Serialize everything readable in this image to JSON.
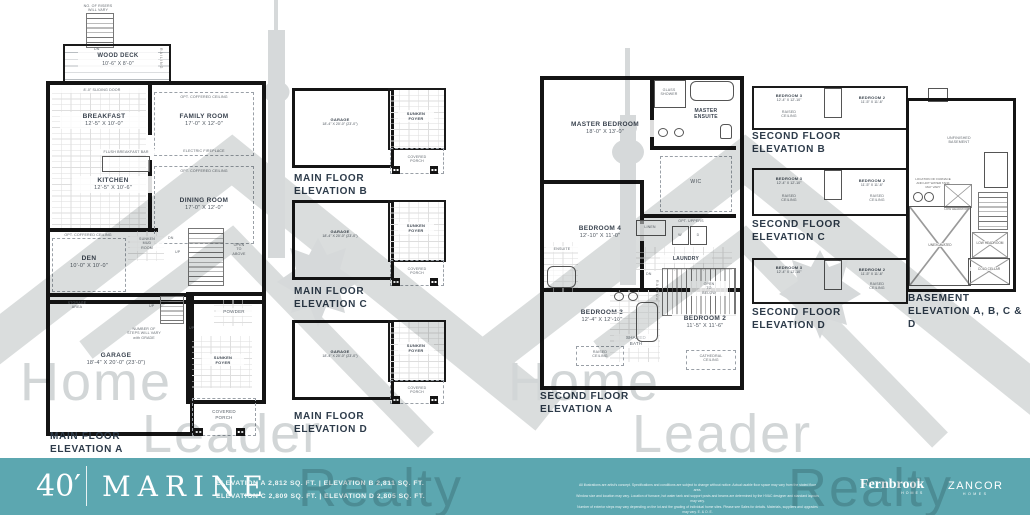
{
  "wm": {
    "w1": "Home",
    "w2": "Leader",
    "w3": "Realty"
  },
  "mfa": {
    "t1": "MAIN FLOOR",
    "t2": "ELEVATION A",
    "risers1": "NO. OF RISERS",
    "risers2": "WILL VARY",
    "dn": "DN",
    "up": "UP",
    "deck1": "WOOD DECK",
    "deck2": "10'-6\" X 8'-0\"",
    "railing": "RAILING",
    "sliding": "8'-0\" SLIDING DOOR",
    "coff": "OPT. COFFERED CEILING",
    "brk1": "BREAKFAST",
    "brk2": "12'-5\" X 10'-0\"",
    "fam1": "FAMILY ROOM",
    "fam2": "17'-0\" X 12'-0\"",
    "fire": "ELECTRIC FIREPLACE",
    "bar": "FLUSH BREAKFAST BAR",
    "kit1": "KITCHEN",
    "kit2": "12'-5\" X 10'-6\"",
    "din1": "DINING ROOM",
    "din2": "17'-0\" X 12'-0\"",
    "den1": "DEN",
    "den2": "10'-0\" X 10'-0\"",
    "mud1": "SUNKEN",
    "mud2": "MUD",
    "mud3": "ROOM",
    "open1": "OPEN",
    "open2": "TO",
    "open3": "ABOVE",
    "sto1": "STORAGE",
    "sto2": "AREA",
    "gar1": "GARAGE",
    "gar2": "18'-4\" X 20'-0\" (23'-0\")",
    "steps1": "NUMBER OF",
    "steps2": "STEPS WILL VARY",
    "steps3": "with GRADE",
    "pow": "POWDER",
    "foy1": "SUNKEN",
    "foy2": "FOYER",
    "por1": "COVERED",
    "por2": "PORCH"
  },
  "mfb": {
    "t1": "MAIN FLOOR",
    "t2": "ELEVATION B",
    "gar1": "GARAGE",
    "gar2": "18'-4\" X 20'-0\" (23'-0\")",
    "foy1": "SUNKEN",
    "foy2": "FOYER",
    "por1": "COVERED",
    "por2": "PORCH"
  },
  "mfc": {
    "t1": "MAIN FLOOR",
    "t2": "ELEVATION C",
    "gar1": "GARAGE",
    "gar2": "18'-4\" X 20'-0\" (23'-0\")",
    "foy1": "SUNKEN",
    "foy2": "FOYER",
    "por1": "COVERED",
    "por2": "PORCH"
  },
  "mfd": {
    "t1": "MAIN FLOOR",
    "t2": "ELEVATION D",
    "gar1": "GARAGE",
    "gar2": "18'-4\" X 20'-0\" (23'-0\")",
    "foy1": "SUNKEN",
    "foy2": "FOYER",
    "por1": "COVERED",
    "por2": "PORCH"
  },
  "sfa": {
    "t1": "SECOND FLOOR",
    "t2": "ELEVATION A",
    "mas1": "MASTER BEDROOM",
    "mas2": "18'-0\" X 13'-0\"",
    "gs1": "GLASS",
    "gs2": "SHOWER",
    "me1": "MASTER",
    "me2": "ENSUITE",
    "wic": "WIC",
    "b4": "BEDROOM 4",
    "b4d": "12'-10\" X 11'-0\"",
    "lin": "LINEN",
    "optup": "OPT. UPPERS",
    "w": "W",
    "d": "D",
    "lau": "LAUNDRY",
    "dn": "DN",
    "rail": "RAILING",
    "ob1": "OPEN",
    "ob2": "TO",
    "ob3": "BELOW",
    "ens": "ENSUITE",
    "b3": "BEDROOM 3",
    "b3d": "12'-4\" X 12'-10\"",
    "sh1": "SHARED",
    "sh2": "BATH",
    "rc1": "RAISED",
    "rc2": "CEILING",
    "b2": "BEDROOM 2",
    "b2d": "11'-5\" X 11'-6\"",
    "cat1": "CATHEDRAL",
    "cat2": "CEILING"
  },
  "sfb": {
    "t1": "SECOND FLOOR",
    "t2": "ELEVATION B",
    "b3": "BEDROOM 3",
    "b3d": "12'-4\" X 12'-10\"",
    "b2": "BEDROOM 2",
    "b2d": "11'-5\" X 11'-6\"",
    "rc1": "RAISED",
    "rc2": "CEILING"
  },
  "sfc": {
    "t1": "SECOND FLOOR",
    "t2": "ELEVATION C",
    "b3": "BEDROOM 3",
    "b3d": "12'-4\" X 12'-10\"",
    "b2": "BEDROOM 2",
    "b2d": "11'-5\" X 11'-6\"",
    "rc1": "RAISED",
    "rc2": "CEILING"
  },
  "sfd": {
    "t1": "SECOND FLOOR",
    "t2": "ELEVATION D",
    "b3": "BEDROOM 3",
    "b3d": "12'-4\" X 12'-10\"",
    "b2": "BEDROOM 2",
    "b2d": "11'-5\" X 11'-6\"",
    "rc1": "RAISED",
    "rc2": "CEILING"
  },
  "bsm": {
    "t1": "BASEMENT",
    "t2": "ELEVATION A, B, C & D",
    "un1": "UNFINISHED",
    "un2": "BASEMENT",
    "fn1": "LOCATION OF FURNACE",
    "fn2": "AND HOT WATER TANK",
    "fn3": "MAY VARY",
    "lh1": "LOW",
    "lh2": "HEADROOM",
    "unx": "UNEXCAVATED",
    "cc1": "COLD",
    "cc2": "CELLAR"
  },
  "footer": {
    "frontage": "40′",
    "model": "MARINE",
    "spec1": "ELEVATION A 2,812 SQ. FT.   |   ELEVATION B 2,811 SQ. FT.",
    "spec2": "ELEVATION C 2,809 SQ. FT.   |   ELEVATION D 2,805 SQ. FT.",
    "disc1": "All illustrations are artist's concept. Specifications and conditions are subject to change without notice. Actual usable floor space may vary from the stated floor area.",
    "disc2": "Window size and location may vary. Location of furnace, hot water tank and support posts and beams are determined by the HVAC designer and standard layouts may vary.",
    "disc3": "Number of exterior steps may vary depending on the lot and the grading of individual home sites. Please see Sales for details. Materials, suppliers and upgrades may vary. E. & O. E.",
    "fb": "Fernbrook",
    "fbsub": "HOMES",
    "za": "ZANCOR",
    "zasub": "HOMES",
    "accent": "#5CA7B0"
  }
}
